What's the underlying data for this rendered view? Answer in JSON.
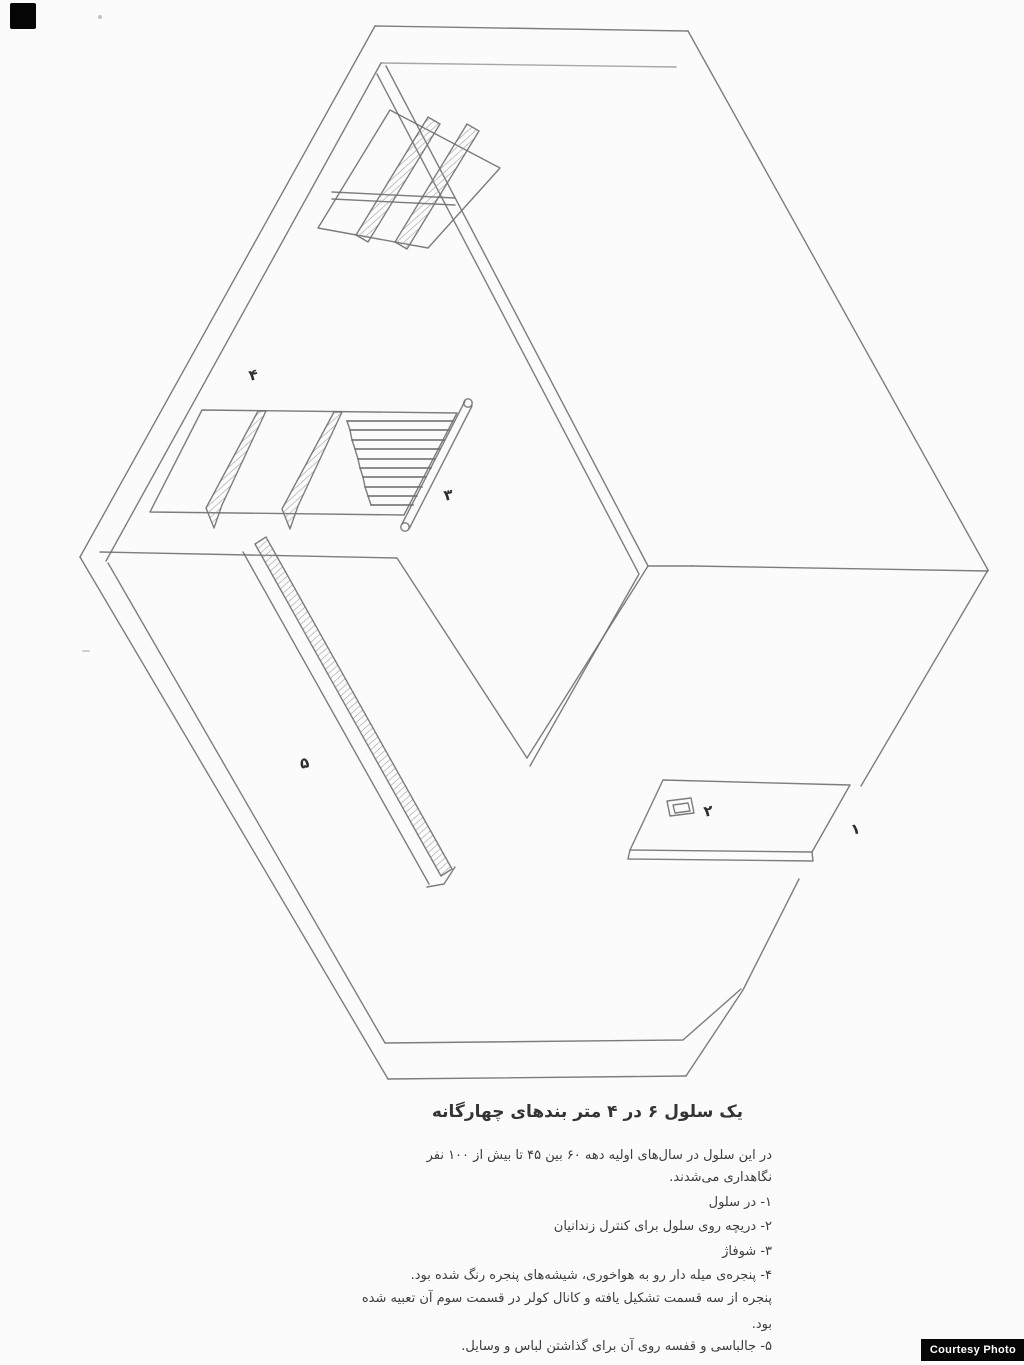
{
  "page": {
    "background": "#fbfbfb"
  },
  "figure": {
    "description": "Isometric cut-away pencil drawing of a 6x4 meter prison cell showing door, hatch, radiator, barred window and coat-rack shelf",
    "line_color": "#6f6f6f",
    "labels": [
      {
        "char": "۴",
        "x": 249,
        "y": 368
      },
      {
        "char": "۳",
        "x": 444,
        "y": 488
      },
      {
        "char": "۵",
        "x": 300,
        "y": 756
      },
      {
        "char": "۲",
        "x": 704,
        "y": 804
      },
      {
        "char": "۱",
        "x": 851,
        "y": 822
      }
    ]
  },
  "caption": {
    "title": "یک سلول ۶ در ۴ متر بندهای چهارگانه",
    "lines": [
      "در این سلول در سال‌های اولیه دهه ۶۰ بین ۴۵ تا بیش از ۱۰۰ نفر",
      "نگاهداری می‌شدند.",
      "۱- در سلول",
      "۲- دریچه روی سلول برای کنترل زندانیان",
      "۳- شوفاژ",
      "۴- پنجره‌ی میله دار رو به هواخوری، شیشه‌های پنجره رنگ شده بود.",
      "پنجره از سه قسمت تشکیل یافته و کانال کولر در قسمت سوم آن تعبیه شده",
      "بود.",
      "۵- جالباسی و قفسه روی آن برای گذاشتن لباس و وسایل."
    ]
  },
  "credit": {
    "label": "Courtesy Photo",
    "bg": "#060606",
    "fg": "#ffffff"
  }
}
